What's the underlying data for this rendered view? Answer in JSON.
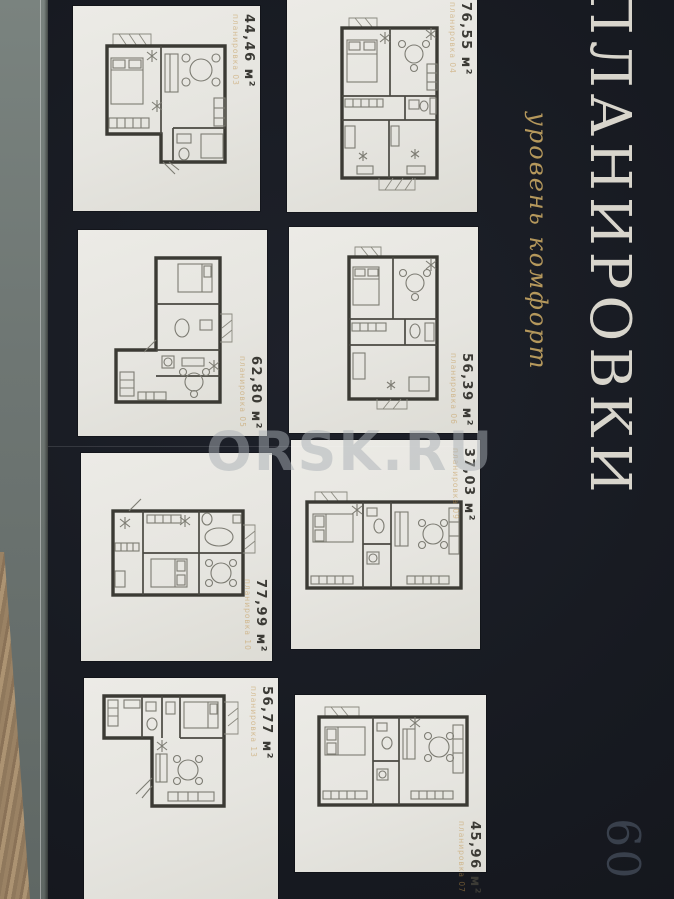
{
  "page": {
    "title": "ПЛАНИРОВКИ",
    "subtitle": "уровень комфорт",
    "page_number": "09",
    "watermark": "ORSK.RU"
  },
  "colors": {
    "background": "#1a1d24",
    "card": "#e8e7e2",
    "walls": "#3b3a34",
    "gold_accent": "#b5985c",
    "plan_code_accent": "#c1944a",
    "title_text": "#d8d5cc"
  },
  "cards": [
    {
      "area": "44,46 м²",
      "code": "планировка 03"
    },
    {
      "area": "76,55 м²",
      "code": "планировка 04"
    },
    {
      "area": "62,80 м²",
      "code": "планировка 05"
    },
    {
      "area": "56,39 м²",
      "code": "планировка 06"
    },
    {
      "area": "77,99 м²",
      "code": "планировка 10"
    },
    {
      "area": "37,03 м²",
      "code": "планировка 09"
    },
    {
      "area": "56,77 м²",
      "code": "планировка 13"
    },
    {
      "area": "45,96 м²",
      "code": "планировка 07"
    }
  ]
}
